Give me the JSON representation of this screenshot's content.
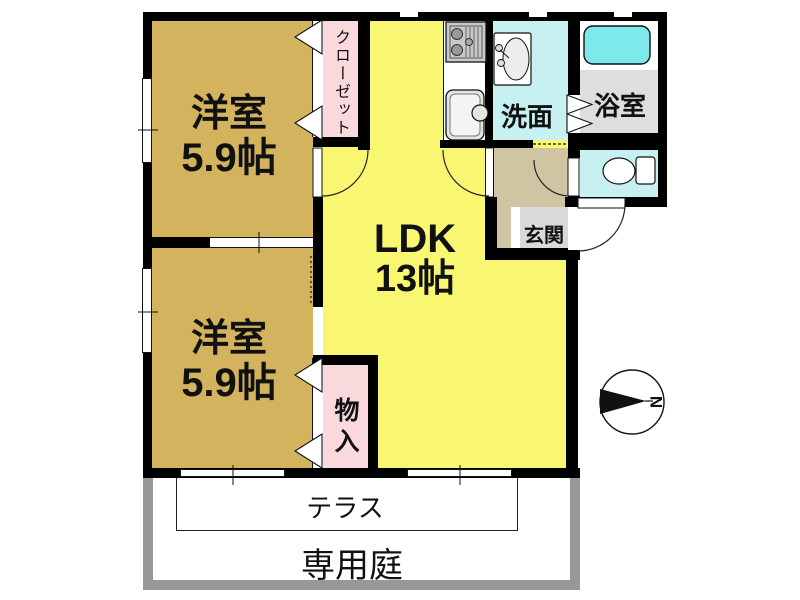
{
  "plan": {
    "rooms": {
      "bedroom1": {
        "name": "洋室",
        "size": "5.9帖"
      },
      "bedroom2": {
        "name": "洋室",
        "size": "5.9帖"
      },
      "ldk": {
        "name": "LDK",
        "size": "13帖"
      },
      "closet": {
        "name": "クローゼット"
      },
      "storage": {
        "name": "物入"
      },
      "washroom": {
        "name": "洗面"
      },
      "bathroom": {
        "name": "浴室"
      },
      "entrance": {
        "name": "玄関"
      }
    },
    "exterior": {
      "terrace": "テラス",
      "garden": "専用庭"
    },
    "compass": {
      "north_label": "N"
    }
  },
  "icons": {
    "stove": "stove-icon",
    "kitchen_sink": "kitchen-sink-icon",
    "washbasin": "washbasin-icon",
    "bathtub": "bathtub-icon",
    "toilet": "toilet-icon",
    "compass": "compass-icon"
  },
  "colors": {
    "wall": "#000000",
    "tan": "#d3b35e",
    "yellow": "#f9f772",
    "pink": "#f9d9dc",
    "cyan": "#c6f0f2",
    "tub": "#7de9eb",
    "bathfloor": "#dedede",
    "genkan": "#d9d9d9",
    "beige": "#cfc5a2",
    "fence": "#98989a"
  }
}
